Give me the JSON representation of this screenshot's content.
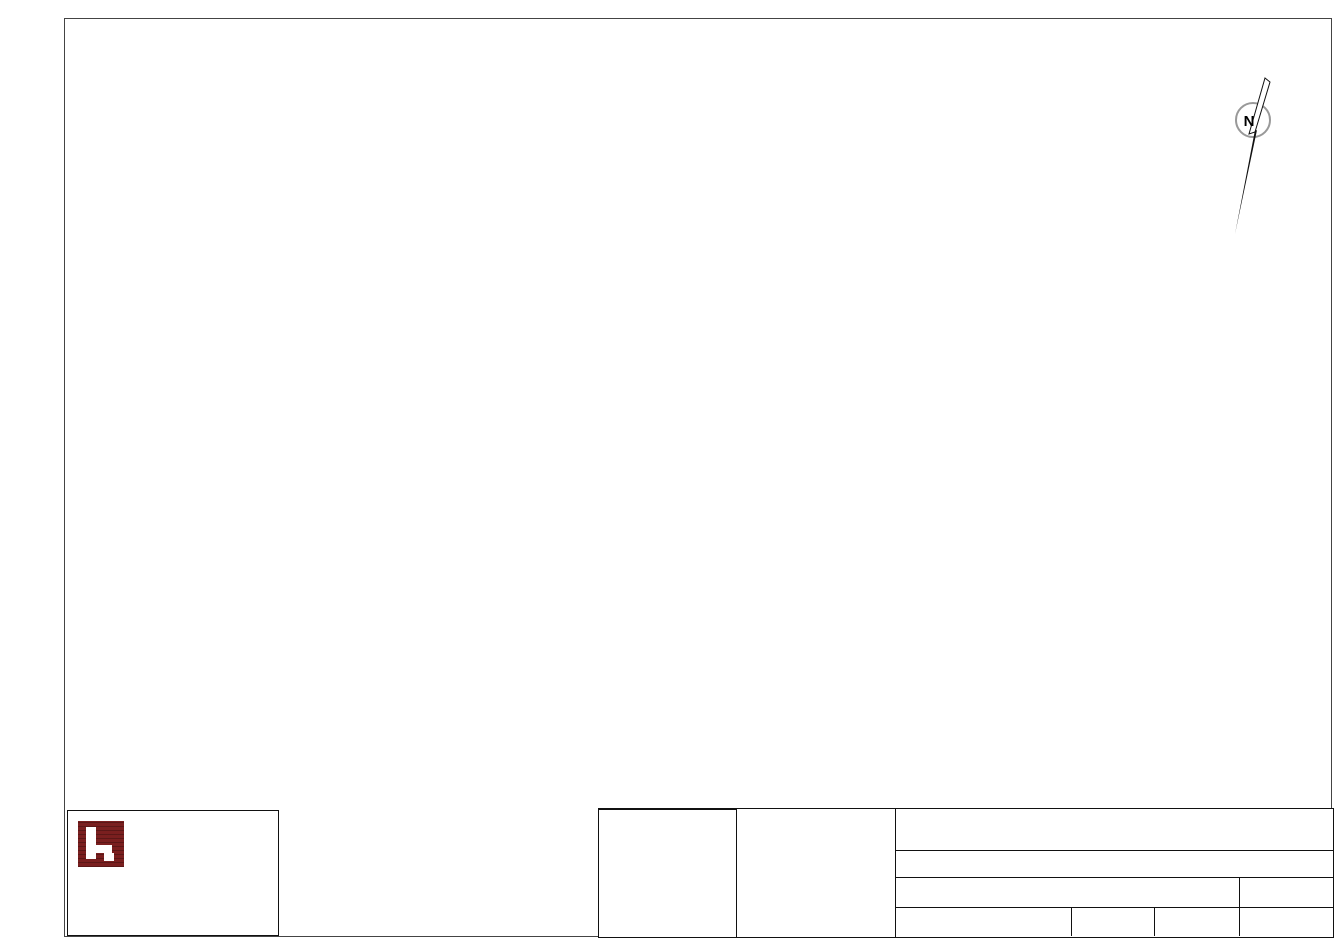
{
  "groups": {
    "271": "#e8112d",
    "272": "#ff00ff",
    "274": "#84a80c",
    "276": "#00dff0",
    "281": "#e8112d",
    "282": "#2050e0",
    "283": "#2bd62b",
    "291": "#e8112d",
    "292": "#869410",
    "293": "#f2e40a",
    "294": "#2a6ae6",
    "295": "#a03010",
    "296": "#9191f0"
  },
  "palette": {
    "wall": "#111111",
    "greenArrow": "#8cd9a6",
    "redLine": "#e30016",
    "stair": "#90d7a4",
    "orange": "#e07820"
  },
  "rulers": {
    "top": {
      "labels": [
        {
          "t": "20m",
          "x": 225
        },
        {
          "t": "40m",
          "x": 548
        },
        {
          "t": "60m",
          "x": 871
        }
      ],
      "ticks": [
        387,
        710,
        1033
      ]
    },
    "left": {
      "labels": [
        {
          "t": "20m",
          "y": 172
        },
        {
          "t": "40m",
          "y": 492
        }
      ],
      "ticks": [
        341,
        664
      ]
    }
  },
  "north_label": "N",
  "plan": {
    "note": "Rauchmelder im Lüftungsschacht oben",
    "walls": [
      [
        272,
        275,
        352,
        275,
        5
      ],
      [
        347,
        268,
        1122,
        268,
        6
      ],
      [
        271,
        277,
        317,
        512,
        5
      ],
      [
        1117,
        268,
        1117,
        515,
        6
      ],
      [
        317,
        510,
        440,
        510,
        6
      ],
      [
        500,
        510,
        600,
        510,
        6
      ],
      [
        660,
        510,
        722,
        510,
        6
      ],
      [
        782,
        510,
        935,
        510,
        6
      ],
      [
        955,
        510,
        972,
        510,
        6
      ],
      [
        1002,
        510,
        1050,
        510,
        6
      ],
      [
        1105,
        510,
        1123,
        510,
        6
      ],
      [
        283,
        340,
        370,
        340,
        4
      ],
      [
        368,
        277,
        368,
        298,
        5
      ],
      [
        368,
        332,
        368,
        510,
        5
      ],
      [
        292,
        418,
        336,
        418,
        4
      ],
      [
        362,
        418,
        370,
        418,
        4
      ],
      [
        508,
        268,
        508,
        510,
        5
      ],
      [
        896,
        268,
        896,
        388,
        5
      ],
      [
        896,
        386,
        927,
        386,
        5
      ],
      [
        925,
        268,
        925,
        510,
        5
      ],
      [
        965,
        268,
        965,
        510,
        4
      ],
      [
        925,
        363,
        967,
        363,
        4
      ],
      [
        925,
        420,
        967,
        420,
        4
      ],
      [
        967,
        420,
        975,
        420,
        4
      ],
      [
        1000,
        420,
        1013,
        420,
        4
      ],
      [
        993,
        268,
        993,
        330,
        4
      ],
      [
        993,
        353,
        1013,
        353,
        4
      ],
      [
        1013,
        268,
        1013,
        360,
        5
      ],
      [
        1013,
        390,
        1013,
        472,
        5
      ],
      [
        1013,
        505,
        1013,
        510,
        5
      ],
      [
        317,
        512,
        317,
        680,
        2
      ],
      [
        317,
        680,
        600,
        680,
        2
      ],
      [
        600,
        512,
        600,
        680,
        2
      ]
    ],
    "orange_rects": [
      [
        927,
        272,
        41,
        91
      ],
      [
        927,
        366,
        41,
        54
      ],
      [
        927,
        423,
        41,
        84
      ]
    ],
    "orange_lines": [
      [
        366,
        421,
        366,
        509
      ]
    ],
    "gray_rects": [
      [
        966,
        416,
        47,
        94
      ],
      [
        993,
        355,
        20,
        61
      ]
    ],
    "windows_top": [
      450,
      627,
      712,
      768,
      852,
      908,
      958,
      1018
    ],
    "windows_right": [
      288,
      333,
      443,
      473
    ],
    "stairs": [
      {
        "x": 347,
        "y": 275,
        "w": 110,
        "h": 32,
        "dir": "h"
      },
      {
        "x": 457,
        "y": 275,
        "w": 28,
        "h": 32,
        "dir": "solid"
      },
      {
        "x": 966,
        "y": 330,
        "w": 28,
        "h": 85,
        "dir": "v"
      }
    ],
    "landing": {
      "x": 396,
      "y": 279,
      "w": 58,
      "h": 42
    },
    "stairbox": {
      "x": 1028,
      "y": 277,
      "w": 42,
      "h": 44
    },
    "stair_glyphs": [
      [
        421,
        284
      ],
      [
        1040,
        291
      ]
    ],
    "brackets": [
      [
        437,
        297
      ]
    ],
    "detectors": [
      {
        "id": "274/04E",
        "x": 327,
        "y": 296,
        "pos": "right"
      },
      {
        "id": "274/03",
        "x": 328,
        "y": 310,
        "pos": "below"
      },
      {
        "id": "274/02",
        "x": 332,
        "y": 381,
        "pos": "above"
      },
      {
        "id": "274/01",
        "x": 339,
        "y": 464,
        "pos": "above"
      },
      {
        "id": "272/03",
        "x": 399,
        "y": 339,
        "pos": "above"
      },
      {
        "id": "272/04E",
        "x": 473,
        "y": 339,
        "pos": "above"
      },
      {
        "id": "272/01",
        "x": 399,
        "y": 456,
        "pos": "above"
      },
      {
        "id": "272/02",
        "x": 475,
        "y": 458,
        "pos": "above"
      },
      {
        "id": "283/03",
        "x": 568,
        "y": 333,
        "pos": "above"
      },
      {
        "id": "283/04",
        "x": 683,
        "y": 334,
        "pos": "above"
      },
      {
        "id": "283/05",
        "x": 776,
        "y": 331,
        "pos": "above"
      },
      {
        "id": "283/06E",
        "x": 857,
        "y": 332,
        "pos": "above"
      },
      {
        "id": "283/01",
        "x": 565,
        "y": 459,
        "pos": "above"
      },
      {
        "id": "283/02",
        "x": 684,
        "y": 459,
        "pos": "above"
      },
      {
        "id": "282/03E",
        "x": 915,
        "y": 348,
        "pos": "above"
      },
      {
        "id": "282/01",
        "x": 792,
        "y": 450,
        "pos": "above"
      },
      {
        "id": "282/02",
        "x": 881,
        "y": 449,
        "pos": "above"
      },
      {
        "id": "295/02E",
        "x": 948,
        "y": 307,
        "pos": "above",
        "sounder": 1
      },
      {
        "id": "295/01",
        "x": 993,
        "y": 302,
        "pos": "above"
      },
      {
        "id": "296/01E",
        "x": 951,
        "y": 391,
        "pos": "above"
      },
      {
        "id": "292/02E",
        "x": 988,
        "y": 401,
        "pos": "below",
        "sounder": 1
      },
      {
        "id": "292/01",
        "x": 990,
        "y": 454,
        "pos": "above"
      },
      {
        "id": "293/01E",
        "x": 952,
        "y": 462,
        "pos": "above"
      },
      {
        "id": "294/02E",
        "x": 1063,
        "y": 342,
        "pos": "above",
        "sounder": 1
      },
      {
        "id": "294/01",
        "x": 1066,
        "y": 453,
        "pos": "above"
      },
      {
        "id": "276/02",
        "x": 372,
        "y": 553,
        "pos": "above"
      },
      {
        "id": "276/04",
        "x": 455,
        "y": 553,
        "pos": "above"
      },
      {
        "id": "276/06E",
        "x": 537,
        "y": 552,
        "pos": "above"
      },
      {
        "id": "276/01",
        "x": 373,
        "y": 653,
        "pos": "above"
      },
      {
        "id": "276/03",
        "x": 456,
        "y": 653,
        "pos": "above"
      },
      {
        "id": "276/05",
        "x": 538,
        "y": 645,
        "pos": "above"
      }
    ],
    "call_points": [
      {
        "id": "271/01E",
        "x": 434,
        "y": 505,
        "horn": 1,
        "fk5": 0
      },
      {
        "id": "281/02E",
        "x": 670,
        "y": 505,
        "horn": 1,
        "fk5": 1
      },
      {
        "id": "281/01",
        "x": 790,
        "y": 505,
        "horn": 1,
        "fk5": 1
      },
      {
        "id": "291/01",
        "x": 997,
        "y": 484,
        "horn": 0,
        "fk5": 0
      },
      {
        "id": "291/02E",
        "x": 1037,
        "y": 505,
        "horn": 0,
        "fk5": 0
      }
    ],
    "fk5_solo": [
      {
        "x": 378,
        "y": 303,
        "flip": false
      },
      {
        "x": 362,
        "y": 337,
        "flip": true
      }
    ],
    "ext_signs": [
      {
        "x": 308,
        "y": 277,
        "l": "D"
      },
      {
        "x": 391,
        "y": 390,
        "l": "F"
      }
    ],
    "chips": [
      {
        "t": "EI30-C",
        "x": 975,
        "y": 314
      },
      {
        "t": "EI30-C",
        "x": 1005,
        "y": 353
      },
      {
        "t": "EI30-C",
        "x": 950,
        "y": 411
      },
      {
        "t": "EI30-C",
        "x": 952,
        "y": 435
      },
      {
        "t": "T30",
        "x": 348,
        "y": 410
      }
    ],
    "green_arrows": [
      [
        493,
        462
      ],
      [
        632,
        462
      ],
      [
        753,
        462
      ],
      [
        977,
        452
      ],
      [
        1092,
        470
      ]
    ],
    "red_arrows": [
      [
        491,
        528
      ],
      [
        633,
        530
      ],
      [
        754,
        531
      ],
      [
        986,
        518
      ],
      [
        1094,
        540
      ]
    ],
    "valves": [
      {
        "x": 960,
        "y": 239,
        "c": "#1414cc",
        "t": "W"
      },
      {
        "x": 1007,
        "y": 524,
        "c": "#f0df00",
        "t": "G"
      }
    ],
    "columns": [
      [
        593,
        393
      ],
      [
        676,
        393
      ],
      [
        752,
        363
      ],
      [
        826,
        364
      ],
      [
        752,
        424
      ],
      [
        826,
        424
      ],
      [
        897,
        424
      ]
    ],
    "arcs": [
      [
        368,
        302,
        396,
        330,
        0
      ],
      [
        455,
        280,
        481,
        306,
        0
      ],
      [
        990,
        356,
        1011,
        377,
        1
      ],
      [
        975,
        427,
        998,
        450,
        0
      ],
      [
        933,
        510,
        955,
        488,
        1
      ],
      [
        1052,
        512,
        1075,
        535,
        0
      ]
    ],
    "double_doors": [
      470,
      630,
      752
    ],
    "leaders": [
      [
        957,
        247,
        949,
        291
      ],
      [
        392,
        262,
        420,
        278
      ]
    ],
    "dots": [
      [
        949,
        291
      ]
    ],
    "heiz_symbol": {
      "x": 933,
      "y": 332
    },
    "diesel_warn": {
      "x": 339,
      "y": 478,
      "letter": "B",
      "tag": "DIESEL"
    },
    "ladder": {
      "x": 297,
      "y": 504
    },
    "height_mark": {
      "x": 337,
      "y": 637,
      "t": "2,6"
    },
    "labels": [
      {
        "t": "Rauchmelder im Lüftungsschacht oben",
        "x": 258,
        "y": 251,
        "s": 11,
        "a": "left"
      },
      {
        "t": "KOMPRESSOR",
        "x": 330,
        "y": 298
      },
      {
        "t": "LAGER",
        "x": 331,
        "y": 395
      },
      {
        "t": "DIESELLAGER",
        "x": 337,
        "y": 435
      },
      {
        "t": "LAGER",
        "x": 445,
        "y": 380
      },
      {
        "t": "TIEFZIEHTEILE",
        "x": 445,
        "y": 392
      },
      {
        "t": "LAGER",
        "x": 650,
        "y": 371
      },
      {
        "t": "LAGER",
        "x": 840,
        "y": 410
      },
      {
        "t": "GASZÄHLER",
        "x": 912,
        "y": 383,
        "s": 9,
        "r": -90
      },
      {
        "t": "HEIZRAUM",
        "x": 953,
        "y": 342,
        "s": 8.5,
        "r": -90
      },
      {
        "t": "E-RAUM",
        "x": 1003,
        "y": 322,
        "s": 8.5,
        "r": -90
      },
      {
        "t": "VR.",
        "x": 1004,
        "y": 379,
        "s": 9
      },
      {
        "t": "MÜLL",
        "x": 949,
        "y": 476
      },
      {
        "t": "LAGER",
        "x": 1064,
        "y": 370
      },
      {
        "t": "Oberndorfer",
        "x": 1064,
        "y": 382
      },
      {
        "t": "FLUGDACH",
        "x": 455,
        "y": 594
      },
      {
        "t": "SPRITZGUSS",
        "x": 455,
        "y": 606
      },
      {
        "t": "DACH",
        "x": 270,
        "y": 484,
        "a": "left"
      },
      {
        "t": "EG",
        "x": 270,
        "y": 496,
        "a": "left"
      },
      {
        "t": "E",
        "x": 417,
        "y": 288,
        "b": 1
      },
      {
        "t": "K",
        "x": 449,
        "y": 310,
        "b": 1
      },
      {
        "t": "1",
        "x": 1038,
        "y": 288,
        "s": 9,
        "b": 1
      },
      {
        "t": "K",
        "x": 1057,
        "y": 312,
        "s": 9,
        "b": 1
      },
      {
        "t": "W",
        "x": 963,
        "y": 250
      },
      {
        "t": "G",
        "x": 1007,
        "y": 534
      },
      {
        "t": "H",
        "x": 934,
        "y": 324,
        "s": 9,
        "b": 1
      }
    ]
  },
  "legend": {
    "title": "MELDERGRUPPEN",
    "rows": [
      [
        "271",
        "272",
        "274",
        "281"
      ],
      [
        "282",
        "283",
        "291",
        "292"
      ],
      [
        "293",
        "294",
        "295",
        "296"
      ],
      [
        "276",
        "",
        "",
        ""
      ],
      [
        "",
        "",
        "",
        ""
      ]
    ]
  },
  "situation": {
    "label": "SITUATION:",
    "rects": [
      {
        "x": 29,
        "y": 14,
        "w": 70,
        "h": 19,
        "red": false
      },
      {
        "x": 99,
        "y": 12,
        "w": 18,
        "h": 21,
        "red": false
      },
      {
        "x": 61,
        "y": 57,
        "w": 58,
        "h": 17,
        "red": true
      },
      {
        "x": 31,
        "y": 75,
        "w": 51,
        "h": 14,
        "red": false
      },
      {
        "x": 31,
        "y": 89,
        "w": 35,
        "h": 25,
        "red": false
      },
      {
        "x": 66,
        "y": 89,
        "w": 46,
        "h": 25,
        "red": false
      }
    ],
    "lines": [
      [
        54,
        33,
        63,
        57
      ],
      [
        77,
        33,
        77,
        57
      ]
    ]
  },
  "titleblock": {
    "title": "BRANDSCHUTZPLAN",
    "objekt_label": "OBJEKT:",
    "adresse_label": "ADRESSE:",
    "gezeichnet_label": "GEZEICHNET:",
    "gezeichnet": "IH-Haider",
    "darstellung_label": "DARSTELLUNG:",
    "darstellung": "KG Büro-alt",
    "massstab_label": "MASSSTAB:",
    "massstab": "1:200",
    "stand_label": "STAND:",
    "stand": "10.08.2024",
    "plannummer_label": "PLANNUMMER:",
    "plannummer": "07 von 12"
  },
  "logo": {
    "brand_top": "INGENIEURBÜRO",
    "brand_bottom": "HAIDER",
    "lines": [
      "IH Maschinenbau-Brandschutz e.U.",
      "Dipl. Ing. Georg Haider, MSc",
      "Pesendorf 18",
      "4551 Ried im Traunkreis",
      "Tel.: 0664 / 2731195",
      "Mail: office@ih-haider.at"
    ]
  },
  "scalebar": {
    "labels": [
      {
        "t": "0m",
        "x": 80,
        "a": "left"
      },
      {
        "t": "10m",
        "x": 237,
        "a": "center"
      },
      {
        "t": "20m",
        "x": 395,
        "a": "right"
      }
    ],
    "x": 80,
    "y": 790,
    "w": 315,
    "h": 7
  },
  "section": {
    "cols": [
      {
        "x": 1149,
        "roofY": 667,
        "cells": [
          {
            "y": 681,
            "t": "E"
          },
          {
            "y": 708,
            "t": "K"
          }
        ]
      },
      {
        "x": 1176,
        "roofY": 613,
        "cells": [
          {
            "y": 627,
            "t": "D"
          },
          {
            "y": 654,
            "t": "1"
          },
          {
            "y": 681,
            "t": "E"
          },
          {
            "y": 708,
            "t": "K"
          }
        ]
      }
    ],
    "cellW": 27,
    "rei_label": "REI90",
    "rei": [
      [
        1212,
        650
      ],
      [
        1212,
        678
      ],
      [
        1212,
        706
      ]
    ],
    "marks": [
      {
        "t": "DH",
        "x": 1148,
        "y": 611,
        "c": "#111"
      },
      {
        "t": "PV",
        "x": 1178,
        "y": 607,
        "c": "#ff00ff"
      },
      {
        "t": "B",
        "x": 1150,
        "y": 628,
        "c": "#111"
      },
      {
        "t": "DH",
        "x": 1116,
        "y": 665,
        "c": "#111"
      },
      {
        "t": "PV",
        "x": 1146,
        "y": 661,
        "c": "#ff00ff"
      },
      {
        "t": "B",
        "x": 1114,
        "y": 684,
        "c": "#111"
      }
    ],
    "diamonds": [
      [
        1164,
        648
      ],
      [
        1140,
        678
      ],
      [
        1140,
        703
      ]
    ],
    "redbox": [
      1146,
      706,
      61,
      31
    ]
  }
}
